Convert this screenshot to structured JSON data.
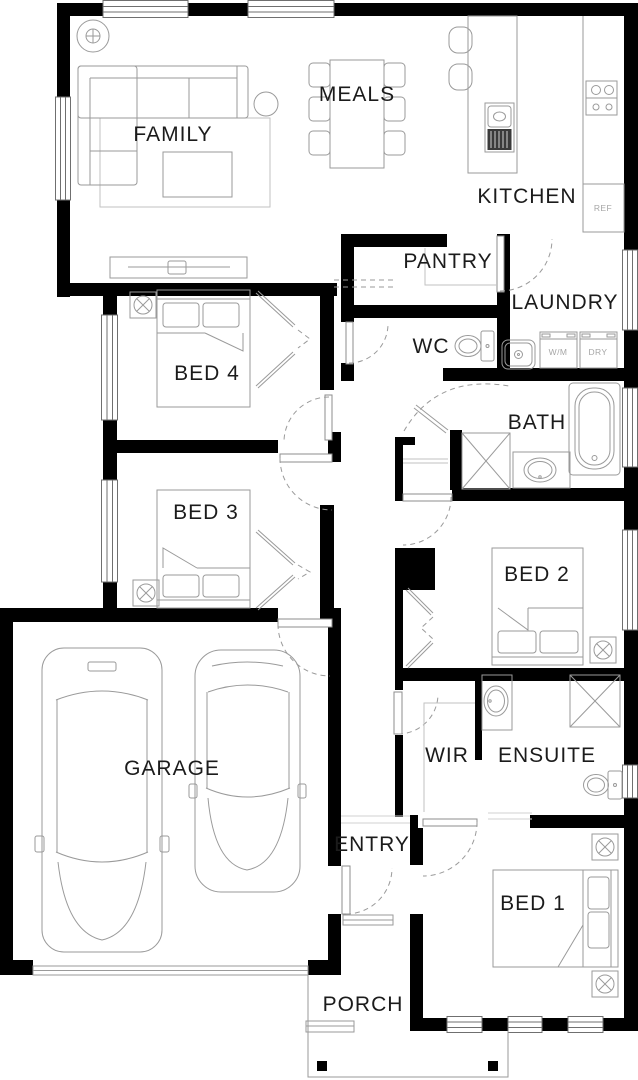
{
  "floorplan": {
    "rooms": {
      "family": "FAMILY",
      "meals": "MEALS",
      "kitchen": "KITCHEN",
      "pantry": "PANTRY",
      "laundry": "LAUNDRY",
      "wc": "WC",
      "bed4": "BED 4",
      "bath": "BATH",
      "bed3": "BED 3",
      "bed2": "BED 2",
      "garage": "GARAGE",
      "wir": "WIR",
      "ensuite": "ENSUITE",
      "entry": "ENTRY",
      "bed1": "BED 1",
      "porch": "PORCH"
    },
    "appliances": {
      "fridge": "REF",
      "washer": "W/M",
      "dryer": "DRY"
    },
    "colors": {
      "wall": "#000000",
      "background": "#ffffff",
      "fixture_line": "#9a9a9a",
      "label": "#1b1b1b",
      "muted_label": "#a6a6a6"
    }
  }
}
